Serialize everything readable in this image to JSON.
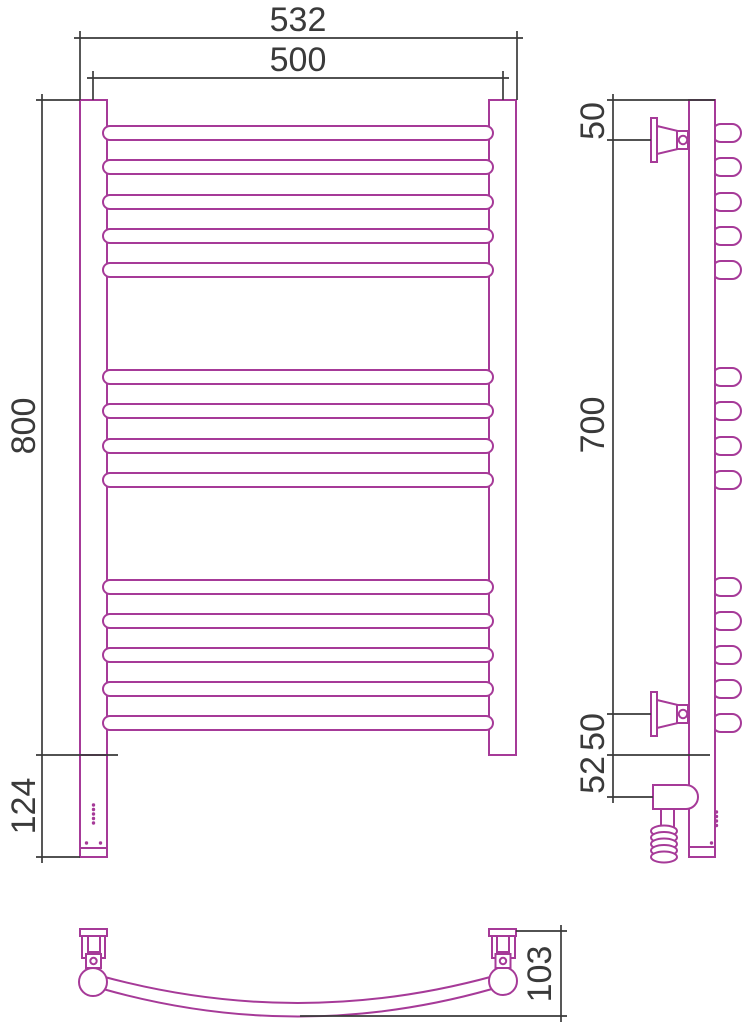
{
  "drawing": {
    "kind": "technical-drawing",
    "subject": "ladder towel rail with wall brackets and electric heating element",
    "views": [
      "front",
      "side",
      "bottom"
    ]
  },
  "colors": {
    "product_line": "#a63a98",
    "dimension_line": "#3a3a3a",
    "background": "#ffffff"
  },
  "structure": {
    "rung_groups": [
      5,
      4,
      5
    ],
    "rung_total": 14,
    "wall_brackets": 2,
    "has_heating_element": true,
    "has_spiral_power_cable": true
  },
  "dims": {
    "overall_width": "532",
    "mounting_width": "500",
    "height": "800",
    "heater_section": "124",
    "top_to_bracket": "50",
    "bracket_span": "700",
    "bracket_to_bottom": "50",
    "bottom_to_heater": "52",
    "depth": "103"
  }
}
